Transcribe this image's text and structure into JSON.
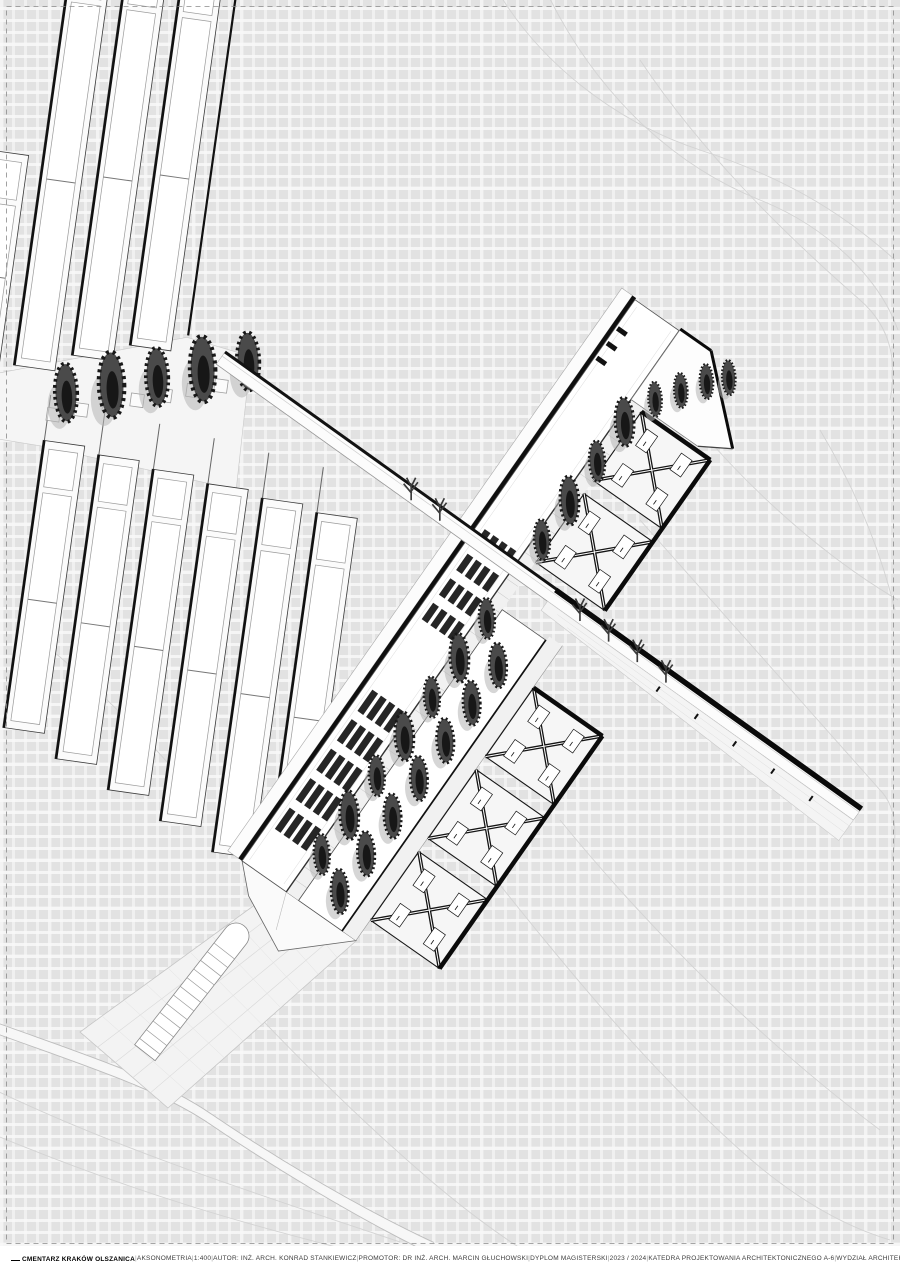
{
  "palette": {
    "background": "#e4e4e4",
    "paper": "#ffffff",
    "ink": "#141414",
    "midline": "#9a9a9a",
    "faint": "#d3d3d3",
    "tree_dark": "#1a1a1a",
    "skylight": "#262626"
  },
  "titleblock": {
    "project": "CMENTARZ KRAKÓW OLSZANICA",
    "drawing": "AKSONOMETRIA",
    "scale": "1:400",
    "author": "AUTOR: INŻ. ARCH. KONRAD STANKIEWICZ",
    "promoter": "PROMOTOR: DR INŻ. ARCH. MARCIN GŁUCHOWSKI",
    "thesis": "DYPLOM MAGISTERSKI",
    "year": "2023 / 2024",
    "department": "KATEDRA PROJEKTOWANIA ARCHITEKTONICZNEGO A-6",
    "faculty": "WYDZIAŁ ARCHITEKTURY POLITECHNIKI KRAKOWSKIEJ",
    "separator": "|"
  }
}
